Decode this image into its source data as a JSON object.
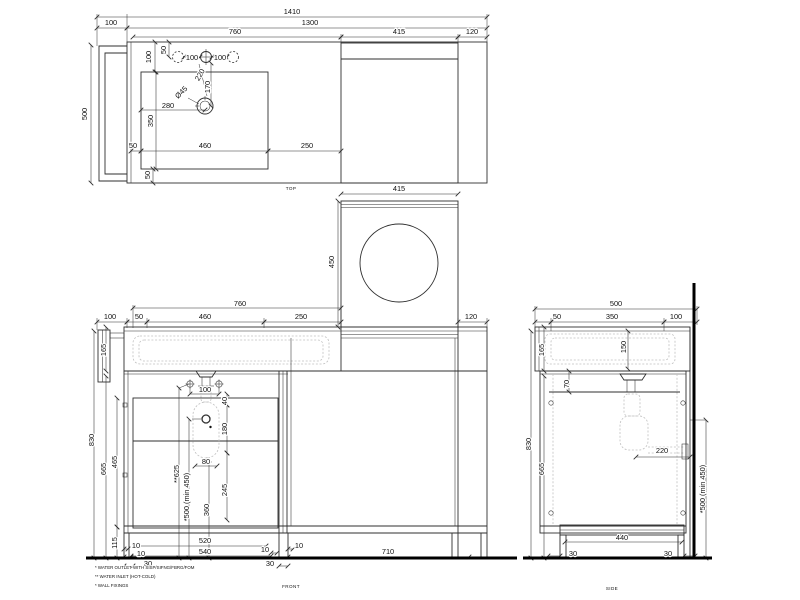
{
  "title": "Vanity unit with washing machine niche - dimensional drawing",
  "colors": {
    "line": "#2f2f2f",
    "hidden": "#c0c0c0",
    "heavy": "#000000",
    "text": "#111111",
    "background": "#ffffff"
  },
  "annotations": {
    "top_view": [
      {
        "n": "dim-overall-1410",
        "t": "1410",
        "x": 292,
        "y": 14
      },
      {
        "n": "dim-1300",
        "t": "1300",
        "x": 310,
        "y": 25
      },
      {
        "n": "dim-bracket-100",
        "t": "100",
        "x": 111,
        "y": 25
      },
      {
        "n": "dim-top-760",
        "t": "760",
        "x": 235,
        "y": 34
      },
      {
        "n": "dim-top-415",
        "t": "415",
        "x": 399,
        "y": 34
      },
      {
        "n": "dim-top-120",
        "t": "120",
        "x": 472,
        "y": 34
      },
      {
        "n": "dim-top-500",
        "t": "500",
        "x": 87,
        "y": 114,
        "r": -90
      },
      {
        "n": "dim-top-100v",
        "t": "100",
        "x": 151,
        "y": 57,
        "r": -90
      },
      {
        "n": "dim-top-50v",
        "t": "50",
        "x": 166,
        "y": 50,
        "r": -90
      },
      {
        "n": "dim-hole-100a",
        "t": "100",
        "x": 192,
        "y": 60
      },
      {
        "n": "dim-hole-100b",
        "t": "100",
        "x": 220,
        "y": 60
      },
      {
        "n": "dim-top-220",
        "t": "220",
        "x": 202,
        "y": 76,
        "r": -60
      },
      {
        "n": "dim-top-170",
        "t": "170",
        "x": 210,
        "y": 87,
        "r": -90
      },
      {
        "n": "dim-drain-d45",
        "t": "Ø45",
        "x": 183,
        "y": 94,
        "r": -45
      },
      {
        "n": "dim-top-280",
        "t": "280",
        "x": 168,
        "y": 108
      },
      {
        "n": "dim-top-350",
        "t": "350",
        "x": 153,
        "y": 121,
        "r": -90
      },
      {
        "n": "dim-top-50s",
        "t": "50",
        "x": 133,
        "y": 148
      },
      {
        "n": "dim-top-460",
        "t": "460",
        "x": 205,
        "y": 148
      },
      {
        "n": "dim-top-250",
        "t": "250",
        "x": 307,
        "y": 148
      },
      {
        "n": "dim-top-50b",
        "t": "50",
        "x": 150,
        "y": 175,
        "r": -90
      }
    ],
    "washer_view": [
      {
        "n": "dim-washer-415",
        "t": "415",
        "x": 399,
        "y": 191
      },
      {
        "n": "dim-washer-450",
        "t": "450",
        "x": 334,
        "y": 262,
        "r": -90
      }
    ],
    "front_view": [
      {
        "n": "dim-front-760",
        "t": "760",
        "x": 240,
        "y": 306
      },
      {
        "n": "dim-front-100",
        "t": "100",
        "x": 110,
        "y": 319
      },
      {
        "n": "dim-front-50",
        "t": "50",
        "x": 139,
        "y": 319
      },
      {
        "n": "dim-front-460",
        "t": "460",
        "x": 205,
        "y": 319
      },
      {
        "n": "dim-front-250",
        "t": "250",
        "x": 301,
        "y": 319
      },
      {
        "n": "dim-front-120",
        "t": "120",
        "x": 471,
        "y": 319
      },
      {
        "n": "dim-front-165",
        "t": "165",
        "x": 106,
        "y": 350,
        "r": -90
      },
      {
        "n": "dim-front-830",
        "t": "830",
        "x": 94,
        "y": 440,
        "r": -90
      },
      {
        "n": "dim-front-665",
        "t": "665",
        "x": 106,
        "y": 469,
        "r": -90
      },
      {
        "n": "dim-front-465",
        "t": "465",
        "x": 117,
        "y": 462,
        "r": -90
      },
      {
        "n": "dim-front-115",
        "t": "115",
        "x": 117,
        "y": 543,
        "r": -90
      },
      {
        "n": "dim-front-100c",
        "t": "100",
        "x": 205,
        "y": 392
      },
      {
        "n": "dim-front-40",
        "t": "40",
        "x": 227,
        "y": 401,
        "r": -90
      },
      {
        "n": "dim-front-180",
        "t": "180",
        "x": 227,
        "y": 429,
        "r": -90
      },
      {
        "n": "dim-front-80",
        "t": "80",
        "x": 206,
        "y": 464
      },
      {
        "n": "dim-front-245",
        "t": "245",
        "x": 227,
        "y": 490,
        "r": -90
      },
      {
        "n": "dim-front-360",
        "t": "360",
        "x": 209,
        "y": 510,
        "r": -90
      },
      {
        "n": "dim-front-625",
        "t": "**625",
        "x": 179,
        "y": 474,
        "r": -90
      },
      {
        "n": "dim-front-500min",
        "t": "*500 (min 450)",
        "x": 189,
        "y": 497,
        "r": -90
      },
      {
        "n": "dim-front-10a",
        "t": "10",
        "x": 136,
        "y": 548
      },
      {
        "n": "dim-front-10b",
        "t": "10",
        "x": 141,
        "y": 556
      },
      {
        "n": "dim-front-30a",
        "t": "30",
        "x": 148,
        "y": 566
      },
      {
        "n": "dim-front-520",
        "t": "520",
        "x": 205,
        "y": 543
      },
      {
        "n": "dim-front-540",
        "t": "540",
        "x": 205,
        "y": 554
      },
      {
        "n": "dim-front-10c",
        "t": "10",
        "x": 265,
        "y": 552
      },
      {
        "n": "dim-front-10d",
        "t": "10",
        "x": 299,
        "y": 548
      },
      {
        "n": "dim-front-30b",
        "t": "30",
        "x": 270,
        "y": 566
      },
      {
        "n": "dim-front-710",
        "t": "710",
        "x": 388,
        "y": 554
      }
    ],
    "side_view": [
      {
        "n": "dim-side-500",
        "t": "500",
        "x": 616,
        "y": 306
      },
      {
        "n": "dim-side-50",
        "t": "50",
        "x": 557,
        "y": 319
      },
      {
        "n": "dim-side-350",
        "t": "350",
        "x": 612,
        "y": 319
      },
      {
        "n": "dim-side-100",
        "t": "100",
        "x": 676,
        "y": 319
      },
      {
        "n": "dim-side-165",
        "t": "165",
        "x": 544,
        "y": 350,
        "r": -90
      },
      {
        "n": "dim-side-150",
        "t": "150",
        "x": 626,
        "y": 347,
        "r": -90
      },
      {
        "n": "dim-side-70",
        "t": "70",
        "x": 569,
        "y": 384,
        "r": -90
      },
      {
        "n": "dim-side-830",
        "t": "830",
        "x": 531,
        "y": 444,
        "r": -90
      },
      {
        "n": "dim-side-665",
        "t": "665",
        "x": 544,
        "y": 469,
        "r": -90
      },
      {
        "n": "dim-side-220",
        "t": "220",
        "x": 662,
        "y": 453
      },
      {
        "n": "dim-side-500min",
        "t": "*500 (min 450)",
        "x": 705,
        "y": 489,
        "r": -90
      },
      {
        "n": "dim-side-440",
        "t": "440",
        "x": 622,
        "y": 540
      },
      {
        "n": "dim-side-30a",
        "t": "30",
        "x": 573,
        "y": 556
      },
      {
        "n": "dim-side-30b",
        "t": "30",
        "x": 668,
        "y": 556
      }
    ],
    "captions": [
      {
        "n": "caption-top",
        "t": "TOP",
        "x": 291,
        "y": 190,
        "s": 4.6,
        "cls": "cap"
      },
      {
        "n": "caption-front",
        "t": "FRONT",
        "x": 291,
        "y": 588,
        "s": 4.6,
        "cls": "cap"
      },
      {
        "n": "caption-side",
        "t": "SIDE",
        "x": 612,
        "y": 590,
        "s": 4.6,
        "cls": "cap"
      }
    ],
    "footnotes": [
      {
        "n": "footnote-water-outlet",
        "t": "* WATER OUTLET WITH SISP/SIFNG/FBRG/FOM",
        "x": 95,
        "y": 569,
        "s": 4.4,
        "a": "start",
        "cls": "fn"
      },
      {
        "n": "footnote-water-inlet",
        "t": "** WATER INLET  (HOT-COLD)",
        "x": 95,
        "y": 578,
        "s": 4.4,
        "a": "start",
        "cls": "fn"
      },
      {
        "n": "footnote-wall-fixings",
        "t": "* WALL FIXINGS",
        "x": 95,
        "y": 587,
        "s": 4.4,
        "a": "start",
        "cls": "fn"
      }
    ]
  }
}
